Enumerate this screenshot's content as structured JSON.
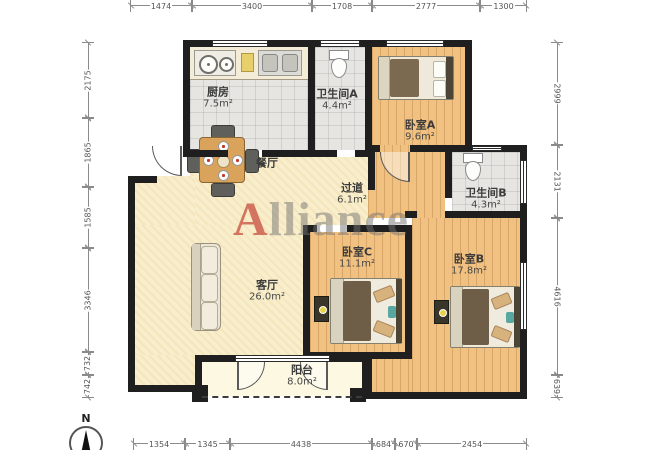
{
  "watermark": {
    "accent_letter": "A",
    "rest": "lliance"
  },
  "compass": {
    "north": "N"
  },
  "rooms": {
    "kitchen": {
      "name": "厨房",
      "area": "7.5m²"
    },
    "bathroom_a": {
      "name": "卫生间A",
      "area": "4.4m²"
    },
    "bedroom_a": {
      "name": "卧室A",
      "area": "9.6m²"
    },
    "dining": {
      "name": "餐厅"
    },
    "hallway": {
      "name": "过道",
      "area": "6.1m²"
    },
    "bathroom_b": {
      "name": "卫生间B",
      "area": "4.3m²"
    },
    "bedroom_c": {
      "name": "卧室C",
      "area": "11.1m²"
    },
    "bedroom_b": {
      "name": "卧室B",
      "area": "17.8m²"
    },
    "living": {
      "name": "客厅",
      "area": "26.0m²"
    },
    "balcony": {
      "name": "阳台",
      "area": "8.0m²"
    }
  },
  "dimensions": {
    "top": [
      "1474",
      "3400",
      "1708",
      "2777",
      "1300"
    ],
    "bottom": [
      "1354",
      "1345",
      "4438",
      "684",
      "670",
      "2454"
    ],
    "left": [
      "2175",
      "1865",
      "1585",
      "3346",
      "732",
      "742"
    ],
    "right": [
      "2999",
      "2131",
      "4616",
      "639"
    ]
  },
  "colors": {
    "wall": "#1f1f1f",
    "wood_floor": "#f0c180",
    "living_floor": "#f9eecb",
    "tile_floor": "#e6e5e1",
    "balcony_floor": "#fcf8e1",
    "watermark_accent": "#c95646",
    "watermark_gray": "#737373",
    "dimension_text": "#555555"
  }
}
